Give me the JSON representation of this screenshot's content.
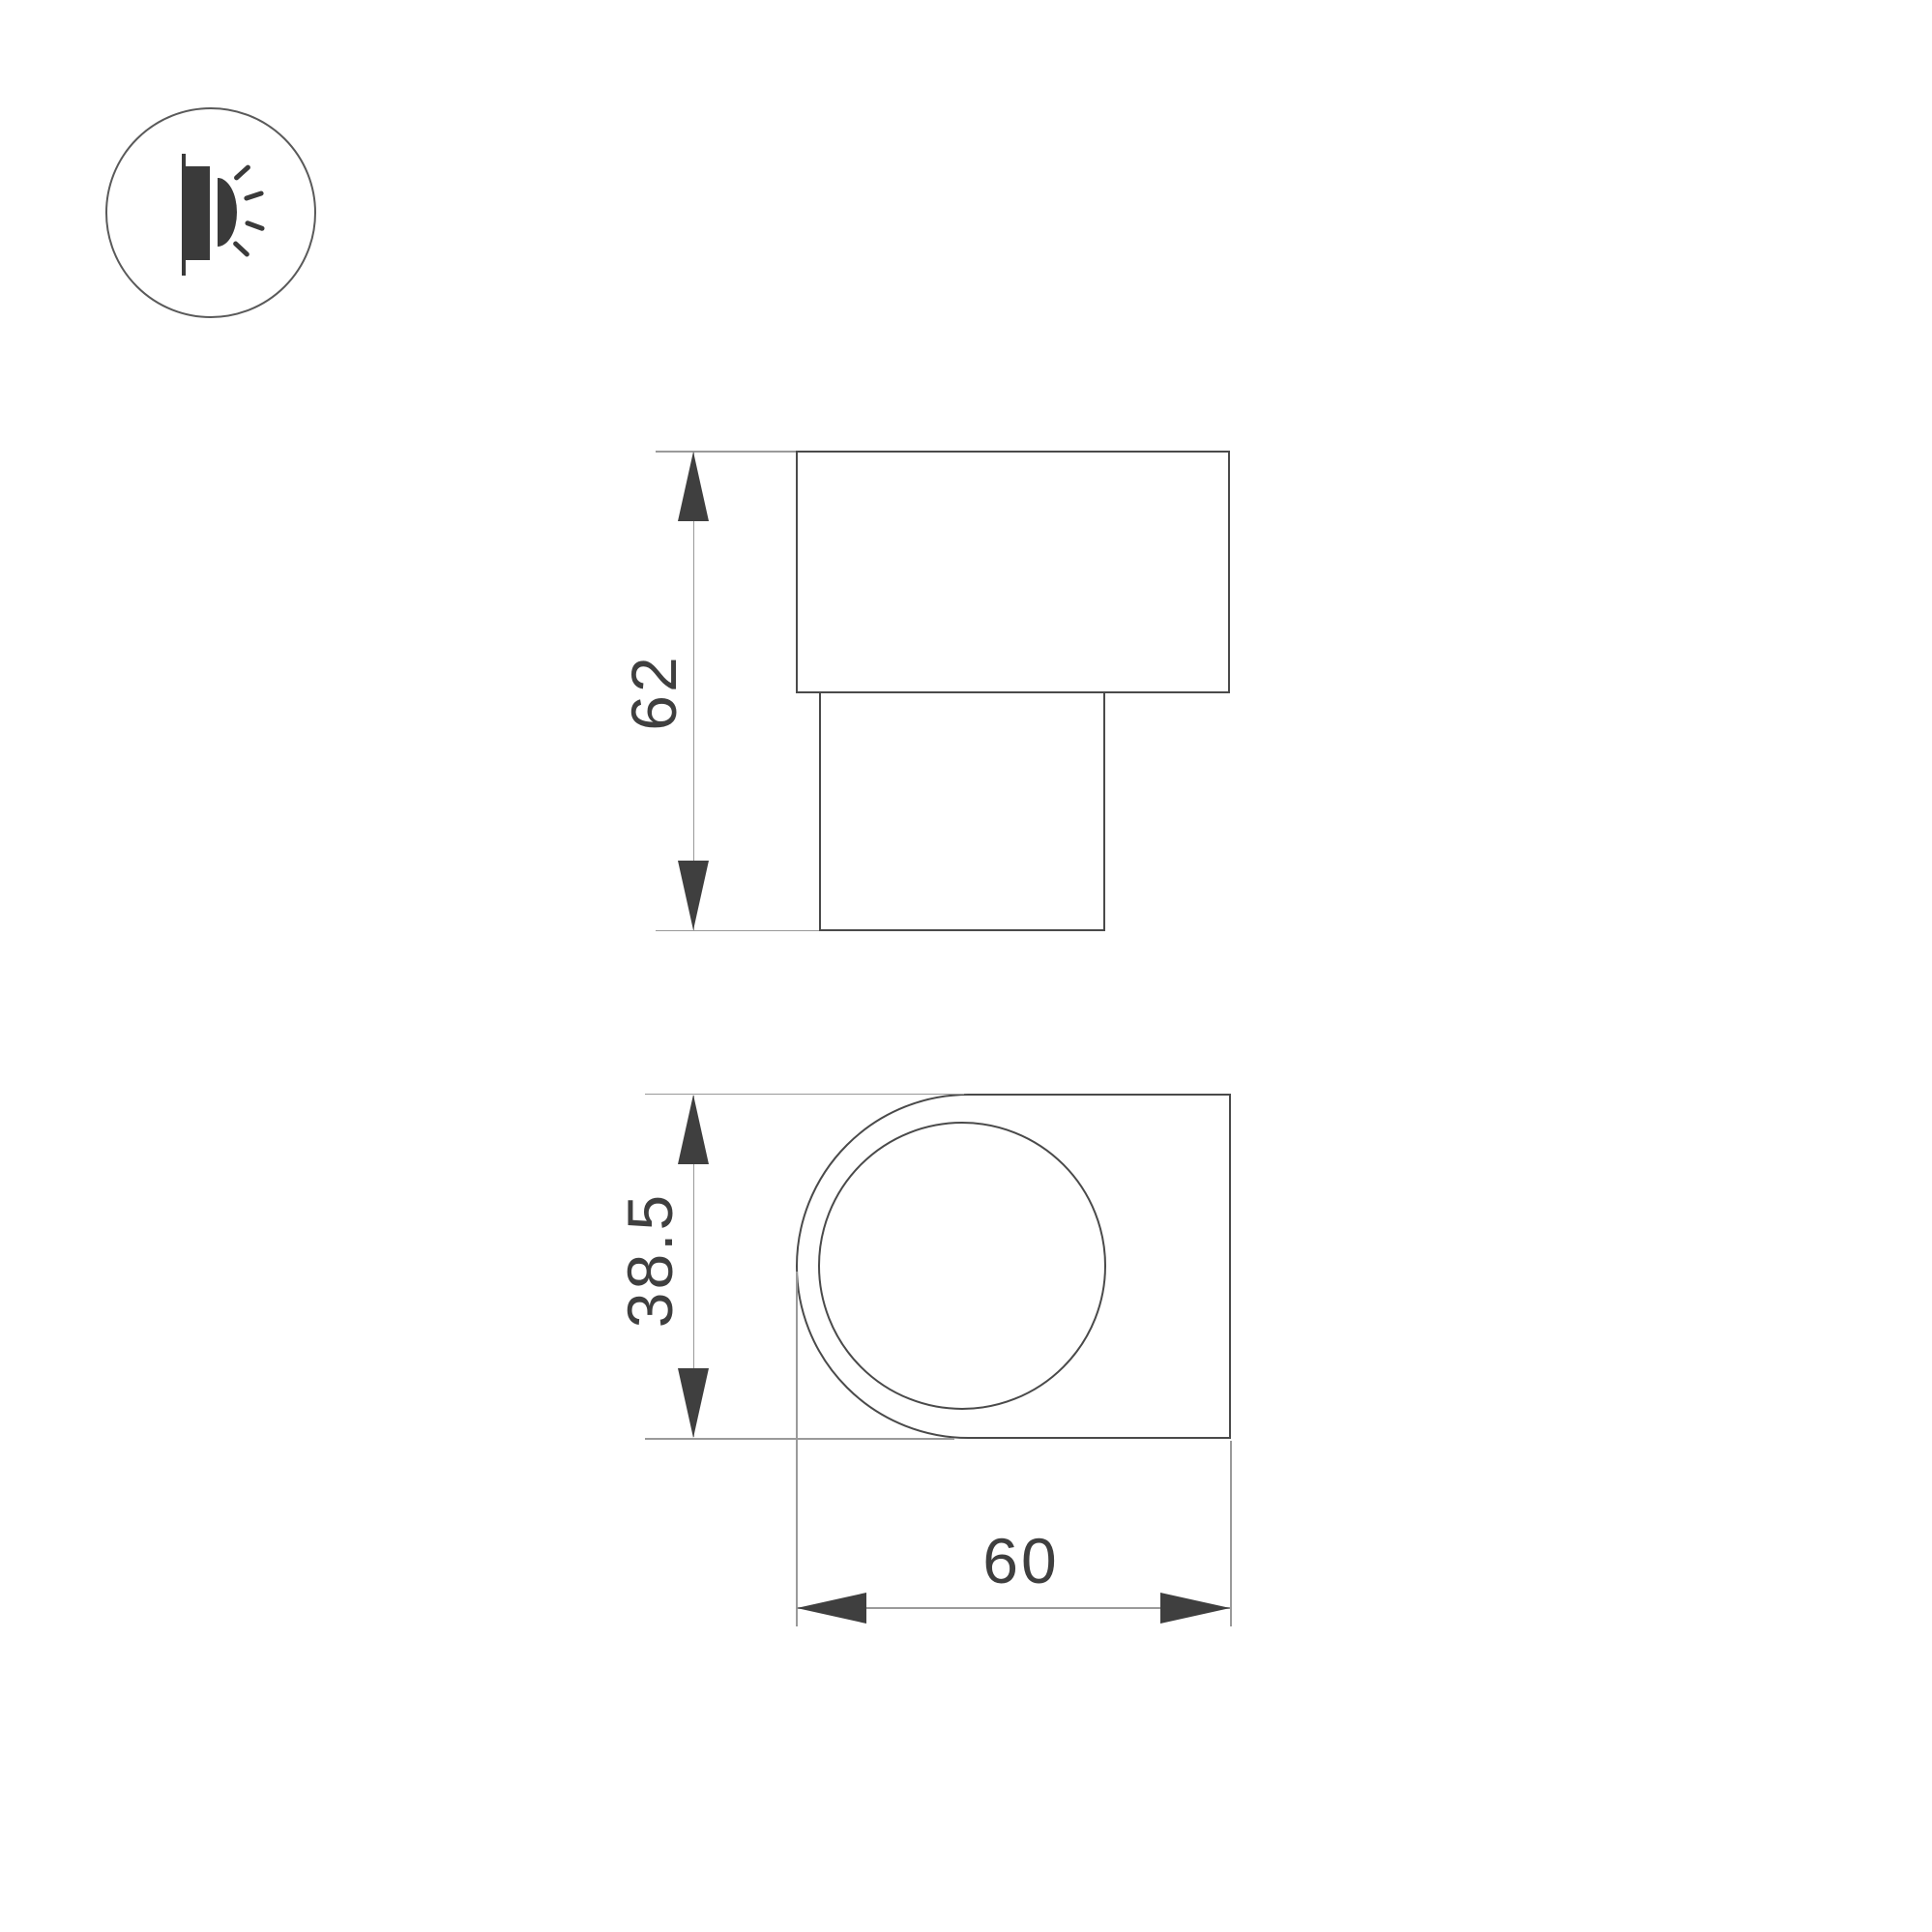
{
  "icon": {
    "name": "wall-light-side-glow-icon"
  },
  "side_view": {
    "height_dim": "62"
  },
  "front_view": {
    "height_dim": "38.5",
    "width_dim": "60"
  },
  "colors": {
    "background": "#ffffff",
    "outline_dark": "#4a4a4a",
    "thin_line": "#9a9a9a",
    "arrow_and_text": "#3f3f3f",
    "icon_fill": "#3a3a3a"
  }
}
